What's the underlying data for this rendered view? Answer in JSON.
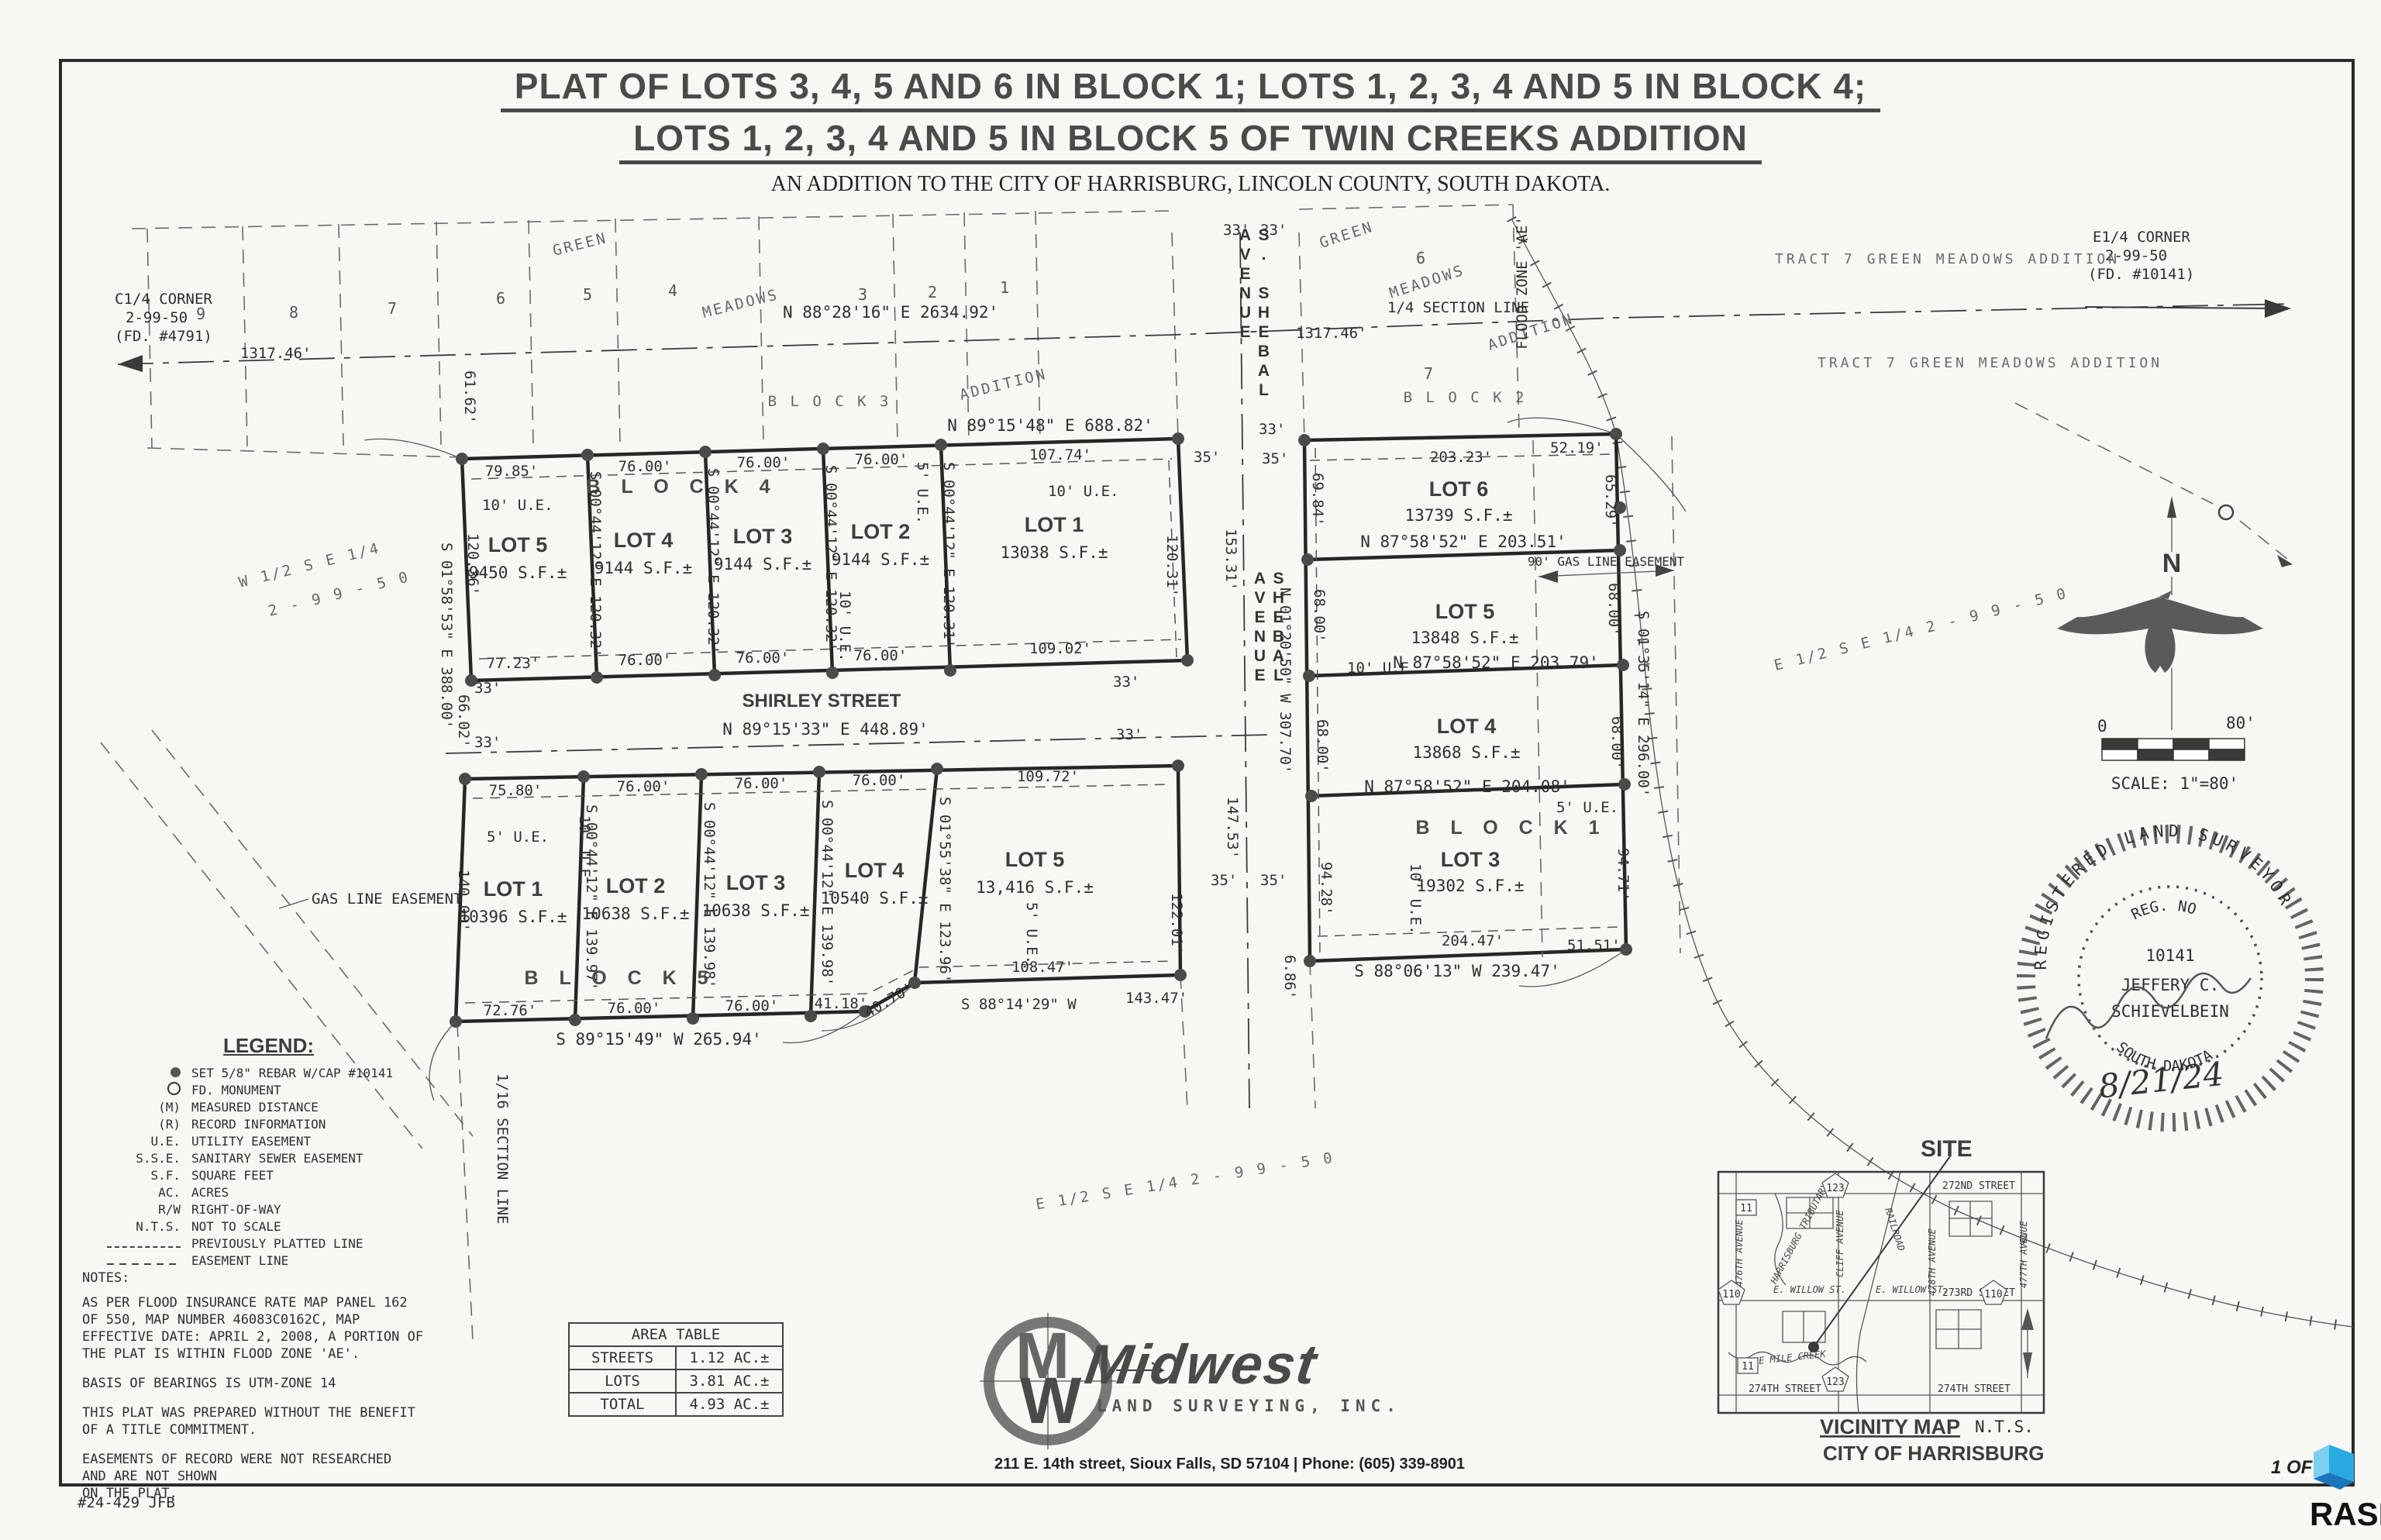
{
  "title": {
    "line1": "PLAT OF LOTS 3, 4, 5 AND 6 IN BLOCK 1; LOTS 1, 2, 3, 4 AND 5 IN BLOCK 4;",
    "line2": "LOTS 1, 2, 3, 4 AND 5 IN BLOCK 5 OF TWIN CREEKS ADDITION",
    "subtitle": "AN ADDITION TO THE CITY OF HARRISBURG, LINCOLN COUNTY, SOUTH DAKOTA."
  },
  "corners": {
    "c14": [
      "C1/4 CORNER",
      "2-99-50",
      "(FD. #4791)"
    ],
    "e14": [
      "E1/4 CORNER",
      "2-99-50",
      "(FD. #10141)"
    ]
  },
  "section": {
    "bearing": "N 88°28'16\" E   2634.92'",
    "label": "1/4 SECTION LINE",
    "left_dist": "1317.46'",
    "right_dist": "1317.46'",
    "sixteenth": "1/16 SECTION LINE"
  },
  "green_meadows": {
    "left": {
      "green": "GREEN",
      "meadows": "MEADOWS",
      "addition": "ADDITION",
      "block": "B L O C K   3",
      "lots": [
        "9",
        "8",
        "7",
        "6",
        "5",
        "4",
        "3",
        "2",
        "1"
      ]
    },
    "right": {
      "green": "GREEN",
      "meadows": "MEADOWS",
      "addition": "ADDITION",
      "block": "B L O C K   2",
      "lot6": "6",
      "lot7": "7"
    },
    "tract1": "TRACT 7 GREEN MEADOWS ADDITION",
    "tract2": "TRACT 7 GREEN MEADOWS ADDITION",
    "flood": "FLOOD ZONE 'AE'",
    "dim_6162": "61.62'"
  },
  "dims": {
    "d33": "33'",
    "d35": "35'"
  },
  "common": {
    "ue5": "5' U.E.",
    "ue10": "10' U.E."
  },
  "shebal": {
    "name_top": "S. SHEBAL AVENUE",
    "name_mid": "SHEBAL AVENUE",
    "bearing": "N 01°20'50\" W  307.70'",
    "d153": "153.31'",
    "d147": "147.53'",
    "d122": "122.01'",
    "d686": "6.86'"
  },
  "block4": {
    "name": "B L O C K   4",
    "top_bearing": "N 89°15'48\" E   688.82'",
    "dims_top": [
      "79.85'",
      "76.00'",
      "76.00'",
      "76.00'",
      "107.74'"
    ],
    "dims_bottom": [
      "77.23'",
      "76.00'",
      "76.00'",
      "76.00'",
      "109.02'"
    ],
    "side": [
      "S 00°44'12\" E  120.32'",
      "S 00°44'12\" E  120.32'",
      "S 00°44'12\" E  120.32'",
      "S 00°44'12\" E  120.31'"
    ],
    "east_in": "120.31'",
    "west": "120.36'",
    "west_line": "S 01°58'53\" E  388.00'",
    "west_66": "66.02'",
    "lots": [
      {
        "n": "LOT 5",
        "a": "9450 S.F.±"
      },
      {
        "n": "LOT 4",
        "a": "9144 S.F.±"
      },
      {
        "n": "LOT 3",
        "a": "9144 S.F.±"
      },
      {
        "n": "LOT 2",
        "a": "9144 S.F.±"
      },
      {
        "n": "LOT 1",
        "a": "13038 S.F.±"
      }
    ]
  },
  "shirley": {
    "name": "SHIRLEY STREET",
    "bearing": "N 89°15'33\" E   448.89'"
  },
  "block5": {
    "name": "B L O C K   5",
    "dims_top": [
      "75.80'",
      "76.00'",
      "76.00'",
      "76.00'",
      "109.72'"
    ],
    "dims_bottom": [
      "72.76'",
      "76.00'",
      "76.00'",
      "41.18'",
      "40.70'"
    ],
    "bottom_bearing": "S 89°15'49\" W   265.94'",
    "bottom_bearing2": "S 88°14'29\" W",
    "d14347": "143.47'",
    "d10847": "108.47'",
    "side": [
      "S 00°44'12\" E  139.97'",
      "S 00°44'12\" E  139.98'",
      "S 00°44'12\" E  139.98'",
      "S 01°55'38\" E  123.96'"
    ],
    "west": "140.00'",
    "lots": [
      {
        "n": "LOT 1",
        "a": "10396 S.F.±"
      },
      {
        "n": "LOT 2",
        "a": "10638 S.F.±"
      },
      {
        "n": "LOT 3",
        "a": "10638 S.F.±"
      },
      {
        "n": "LOT 4",
        "a": "10540 S.F.±"
      },
      {
        "n": "LOT 5",
        "a": "13,416 S.F.±"
      }
    ]
  },
  "block1": {
    "name": "B L O C K   1",
    "d20323": "203.23'",
    "d5219": "52.19'",
    "d6529": "65.29'",
    "b1": "N 87°58'52\" E   203.51'",
    "b2": "N 87°58'52\" E   203.79'",
    "b3": "N 87°58'52\" E   204.08'",
    "gas": "90' GAS LINE EASEMENT",
    "east_bearing": "S 01°35'14\" E  296.00'",
    "w_dims": [
      "69.84'",
      "68.00'",
      "68.00'",
      "94.28'"
    ],
    "e_dims": [
      "68.00'",
      "68.00'",
      "94.71'"
    ],
    "d20447": "204.47'",
    "d5151": "51.51'",
    "bottom_bearing": "S 88°06'13\" W   239.47'",
    "lots": [
      {
        "n": "LOT 6",
        "a": "13739 S.F.±"
      },
      {
        "n": "LOT 5",
        "a": "13848 S.F.±"
      },
      {
        "n": "LOT 4",
        "a": "13868 S.F.±"
      },
      {
        "n": "LOT 3",
        "a": "19302 S.F.±"
      }
    ]
  },
  "quarters": {
    "w1": "W 1/2  S E 1/4",
    "w2": "2 - 9 9 - 5 0",
    "e_mid": "E 1/2  S E 1/4   2 - 9 9 - 5 0",
    "e_right": "E 1/2  S E 1/4   2 - 9 9 - 5 0"
  },
  "gas_easement": "GAS LINE EASEMENT",
  "legend": {
    "title": "LEGEND:",
    "items": [
      {
        "sym": "●",
        "text": "SET 5/8\" REBAR W/CAP #10141"
      },
      {
        "sym": "○",
        "text": "FD. MONUMENT"
      },
      {
        "sym": "(M)",
        "text": "MEASURED DISTANCE"
      },
      {
        "sym": "(R)",
        "text": "RECORD INFORMATION"
      },
      {
        "sym": "U.E.",
        "text": "UTILITY EASEMENT"
      },
      {
        "sym": "S.S.E.",
        "text": "SANITARY SEWER EASEMENT"
      },
      {
        "sym": "S.F.",
        "text": "SQUARE FEET"
      },
      {
        "sym": "AC.",
        "text": "ACRES"
      },
      {
        "sym": "R/W",
        "text": "RIGHT-OF-WAY"
      },
      {
        "sym": "N.T.S.",
        "text": "NOT TO SCALE"
      },
      {
        "sym": "",
        "text": "PREVIOUSLY PLATTED LINE"
      },
      {
        "sym": "",
        "text": "EASEMENT LINE"
      }
    ]
  },
  "notes": {
    "title": "NOTES:",
    "n1": [
      "AS PER FLOOD INSURANCE RATE MAP PANEL 162",
      "OF 550, MAP NUMBER 46083C0162C, MAP",
      "EFFECTIVE DATE: APRIL 2, 2008, A PORTION OF",
      "THE PLAT IS WITHIN FLOOD ZONE 'AE'."
    ],
    "n2": "BASIS OF BEARINGS IS UTM-ZONE 14",
    "n3": [
      "THIS PLAT WAS PREPARED WITHOUT THE BENEFIT",
      "OF A TITLE COMMITMENT."
    ],
    "n4": [
      "EASEMENTS OF RECORD WERE NOT RESEARCHED",
      "AND ARE NOT SHOWN",
      "ON THE PLAT."
    ],
    "job": "#24-429 JFB"
  },
  "area_table": {
    "title": "AREA TABLE",
    "rows": [
      {
        "k": "STREETS",
        "v": "1.12 AC.±"
      },
      {
        "k": "LOTS",
        "v": "3.81 AC.±"
      },
      {
        "k": "TOTAL",
        "v": "4.93 AC.±"
      }
    ]
  },
  "firm": {
    "name": "Midwest",
    "tag": "LAND SURVEYING, INC.",
    "address": "211 E. 14th street, Sioux Falls, SD 57104 | Phone: (605) 339-8901"
  },
  "vicinity": {
    "site": "SITE",
    "caption": "VICINITY MAP",
    "nts": "N.T.S.",
    "city": "CITY OF HARRISBURG",
    "s272": "272ND STREET",
    "s273": "273RD STREET",
    "s274": "274TH STREET",
    "willow": "E. WILLOW ST.",
    "cliff": "CLIFF AVENUE",
    "a478": "478TH AVENUE",
    "a477": "477TH AVENUE",
    "a476": "476TH AVENUE",
    "rail": "RAILROAD",
    "trib": "HARRISBURG TRIBUTARY",
    "creek": "NINE MILE CREEK",
    "h11": "11",
    "h110": "110",
    "h123": "123"
  },
  "stamp": {
    "ring": "REGISTERED LAND SURVEYOR",
    "reg": "REG. NO",
    "no": "10141",
    "name1": "JEFFERY C.",
    "name2": "SCHIEVELBEIN",
    "state": "SOUTH DAKOTA",
    "date": "8/21/24"
  },
  "scalebar": {
    "zero": "0",
    "eighty": "80'",
    "label": "SCALE: 1\"=80'",
    "north": "N"
  },
  "page": {
    "num": "1 OF"
  },
  "watermark": {
    "text": "RASE",
    "color": "#29abe2"
  }
}
